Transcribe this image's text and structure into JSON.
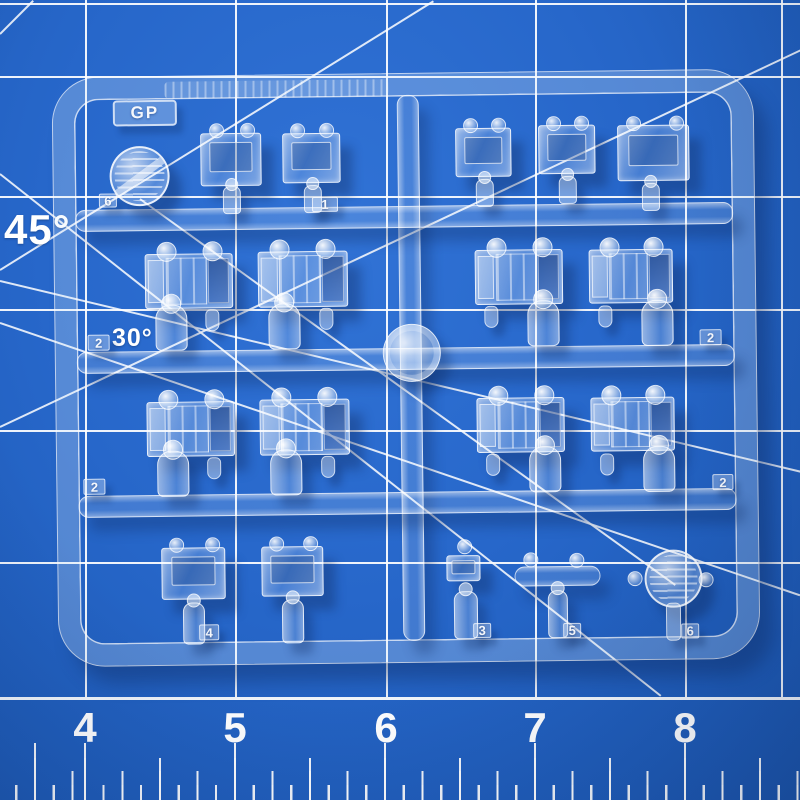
{
  "scene": {
    "subject": "Clear transparent plastic model-kit parts runner (sprue) on a blue self-healing cutting mat"
  },
  "mat": {
    "base_color": "#2a68c9",
    "grid_color": "#ffffff",
    "angle_labels": {
      "deg45": "45°",
      "deg30": "30°"
    },
    "ruler_numbers": [
      "4",
      "5",
      "6",
      "7",
      "8"
    ]
  },
  "sprue": {
    "gate_label": "GP",
    "part_tags": [
      {
        "label": "6"
      },
      {
        "label": "1"
      },
      {
        "label": "2"
      },
      {
        "label": "2"
      },
      {
        "label": "2"
      },
      {
        "label": "2"
      },
      {
        "label": "4"
      },
      {
        "label": "3"
      },
      {
        "label": "5"
      },
      {
        "label": "6"
      }
    ]
  }
}
